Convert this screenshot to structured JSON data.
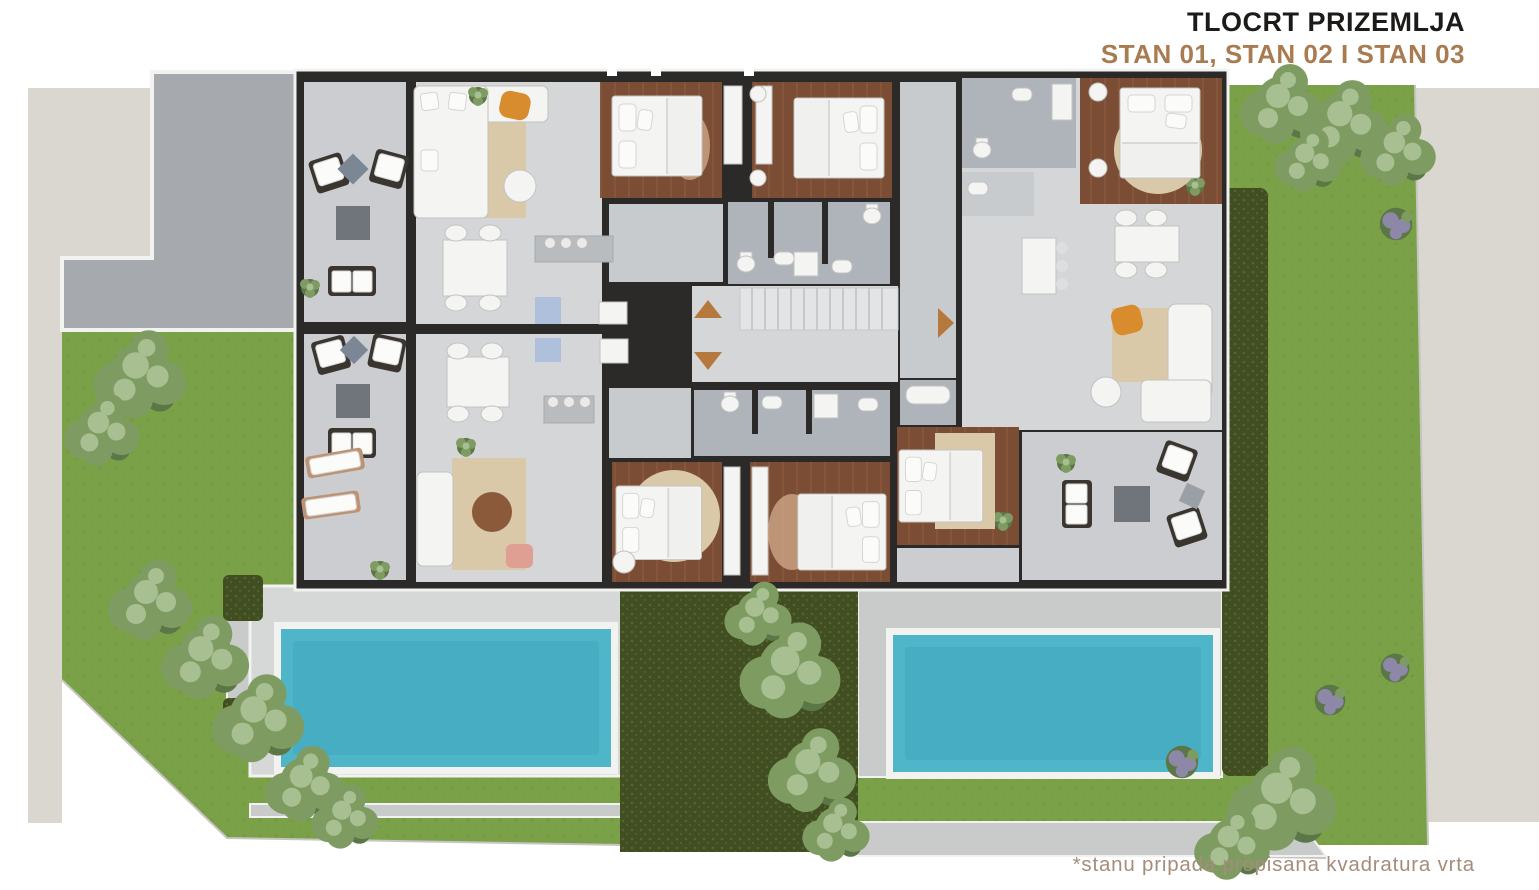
{
  "header": {
    "title": "TLOCRT PRIZEMLJA",
    "subtitle": "STAN 01, STAN 02 I STAN 03"
  },
  "footnote": {
    "text": "*stanu pripada propisana kvadratura vrta"
  },
  "plan": {
    "apartments": [
      "STAN 01",
      "STAN 02",
      "STAN 03"
    ],
    "arrows": [
      {
        "name": "stair-arrow",
        "direction": "up"
      },
      {
        "name": "stair-arrow",
        "direction": "down"
      },
      {
        "name": "entrance-arrow",
        "direction": "right"
      }
    ],
    "features": [
      "driveway",
      "two-pools",
      "gardens",
      "hedges",
      "staircase",
      "terraces",
      "bedrooms",
      "bathrooms",
      "kitchens",
      "living-rooms"
    ]
  },
  "palette": {
    "background": "#ffffff",
    "parcel_beige": "#d9d7cf",
    "grass": "#7aa147",
    "grass_shade": "#6d9340",
    "hedge": "#414e22",
    "hedge_dot": "#566530",
    "tree_light": "#a8bf92",
    "tree_mid": "#7e9c62",
    "tree_dark": "#5b7647",
    "lavender": "#8d87a8",
    "pool_water": "#4fb5c8",
    "pool_deep": "#3da4ba",
    "deck_light": "#d6d7d7",
    "deck_mid": "#c9cbcb",
    "driveway": "#a6aaae",
    "terrace_floor": "#cbcdd0",
    "interior_floor": "#d4d6d8",
    "hall_floor": "#c7cbce",
    "bath_floor": "#aeb4ba",
    "wood_floor": "#7b4d34",
    "wood_plank": "#8a593e",
    "wall": "#2b2a28",
    "white_trim": "#f2f2f0",
    "furniture_white": "#f4f4f2",
    "furniture_stroke": "#c2c2c0",
    "furniture_dark": "#3a352f",
    "table_gray": "#70757c",
    "rug_beige": "#d9c9a8",
    "rug_hide": "#c9a183",
    "accent_orange": "#d98c2e",
    "accent_pink": "#dfa093",
    "accent_blue": "#aec0dc",
    "arrow": "#b5793e",
    "stair": "#e3e4e5",
    "stair_line": "#c6c8ca",
    "ink": "#1c1b19",
    "accent_text": "#a87b50",
    "footnote_text": "#a58c7b"
  }
}
